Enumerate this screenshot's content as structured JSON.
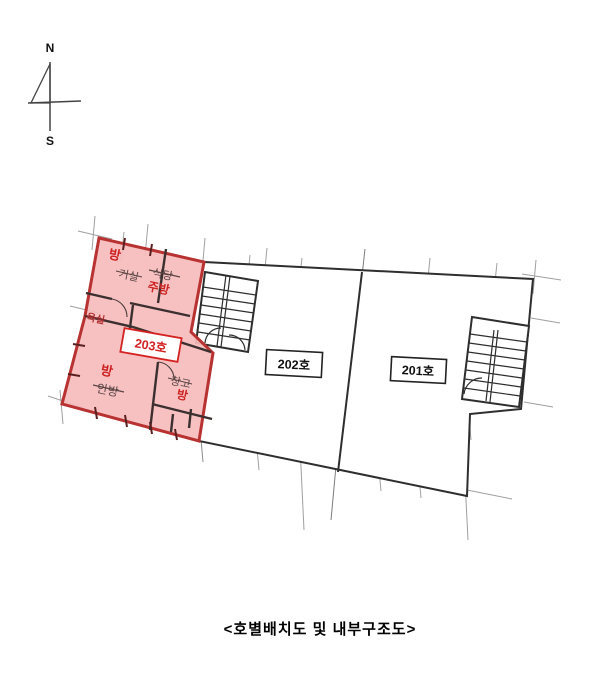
{
  "compass": {
    "north_label": "N",
    "south_label": "S"
  },
  "units": [
    {
      "id": "203",
      "label": "203호",
      "highlighted": true
    },
    {
      "id": "202",
      "label": "202호",
      "highlighted": false
    },
    {
      "id": "201",
      "label": "201호",
      "highlighted": false
    }
  ],
  "rooms_203": [
    {
      "id": "room-northwest",
      "handwritten": "방",
      "printed_crossed_out": "거실"
    },
    {
      "id": "kitchen",
      "handwritten": "주방",
      "printed_crossed_out": "식당"
    },
    {
      "id": "bathroom",
      "handwritten": "욕실",
      "printed_crossed_out": ""
    },
    {
      "id": "room-master",
      "handwritten": "방",
      "printed_crossed_out": "안방"
    },
    {
      "id": "room-small",
      "handwritten": "방",
      "printed_crossed_out": "창고"
    }
  ],
  "caption": "<호별배치도 및 내부구조도>",
  "colors": {
    "highlight_fill": "#f6bcbc",
    "highlight_border": "#b83232",
    "unit_203_label_red": "#d42222",
    "handwriting_red": "#cc2222",
    "wall_dark": "#2e2e2e",
    "extension_line_gray": "#8f8f8f"
  }
}
